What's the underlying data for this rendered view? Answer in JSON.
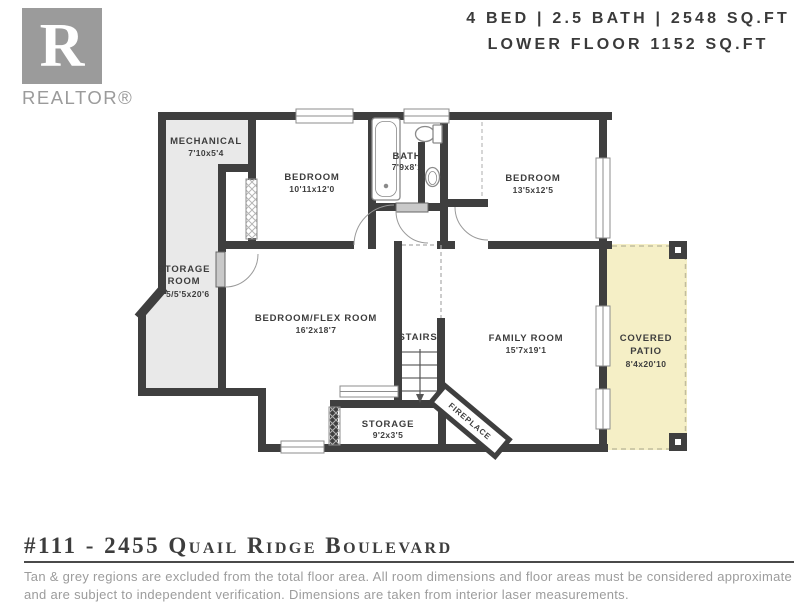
{
  "header": {
    "logo": {
      "letter": "R",
      "brand": "REALTOR®"
    },
    "stats_line1": "4 BED | 2.5 BATH | 2548 SQ.FT",
    "stats_line2": "LOWER FLOOR 1152 SQ.FT"
  },
  "plan": {
    "rooms": {
      "mechanical": {
        "name": "MECHANICAL",
        "dims": "7'10x5'4"
      },
      "bedroom1": {
        "name": "BEDROOM",
        "dims": "10'11x12'0"
      },
      "bath": {
        "name": "BATH",
        "dims": "7'9x8'1"
      },
      "bedroom2": {
        "name": "BEDROOM",
        "dims": "13'5x12'5"
      },
      "storage_room": {
        "name_line1": "STORAGE",
        "name_line2": "ROOM",
        "dims": "7'5/5'5x20'6"
      },
      "flex_room": {
        "name": "BEDROOM/FLEX ROOM",
        "dims": "16'2x18'7"
      },
      "stairs": {
        "name": "STAIRS"
      },
      "family_room": {
        "name": "FAMILY ROOM",
        "dims": "15'7x19'1"
      },
      "covered_patio": {
        "name_line1": "COVERED",
        "name_line2": "PATIO",
        "dims": "8'4x20'10"
      },
      "storage": {
        "name": "STORAGE",
        "dims": "9'2x3'5"
      },
      "fireplace": {
        "name": "FIREPLACE"
      }
    }
  },
  "footer": {
    "address": "#111 - 2455 Quail Ridge Boulevard",
    "disclaimer": "Tan & grey regions are excluded from the total floor area. All room dimensions and floor areas must be considered approximate and are subject to independent verification. Dimensions are taken from interior laser measurements."
  },
  "colors": {
    "wall": "#3f3f3f",
    "excluded_region": "#e9e9e9",
    "patio": "#f5efc6",
    "text_dark": "#3d3d3d",
    "text_gray": "#9b9b9b"
  }
}
